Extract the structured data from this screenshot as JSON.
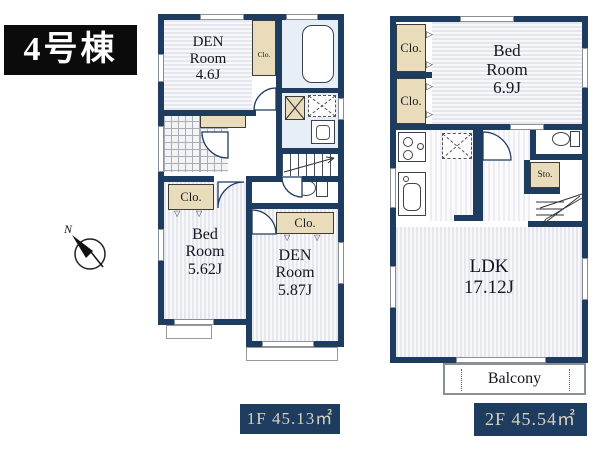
{
  "building_badge": "4号棟",
  "compass": {
    "north": "N"
  },
  "icons": {
    "fold_right": "▷",
    "fold_down": "▽"
  },
  "floor1": {
    "badge": "1F 45.13㎡",
    "den_top": {
      "l1": "DEN",
      "l2": "Room",
      "l3": "4.6J"
    },
    "clo_hall": "Clo.",
    "clo_bed": "Clo.",
    "bed": {
      "l1": "Bed",
      "l2": "Room",
      "l3": "5.62J"
    },
    "clo_den": "Clo.",
    "den_bottom": {
      "l1": "DEN",
      "l2": "Room",
      "l3": "5.87J"
    }
  },
  "floor2": {
    "badge": "2F 45.54㎡",
    "clo_upper": "Clo.",
    "clo_lower": "Clo.",
    "bed": {
      "l1": "Bed",
      "l2": "Room",
      "l3": "6.9J"
    },
    "storage": "Sto.",
    "ldk": {
      "l1": "LDK",
      "l2": "17.12J"
    },
    "balcony": "Balcony"
  },
  "colors": {
    "wall": "#1e3b60",
    "closet": "#e8dcba",
    "floor_stripe": "#e6e6ee",
    "wet_room": "#e7eef6",
    "badge_bg": "#1e3b60",
    "badge_text": "#d8d2bc",
    "title_bg": "#0b0b0b",
    "title_text": "#ffffff"
  }
}
